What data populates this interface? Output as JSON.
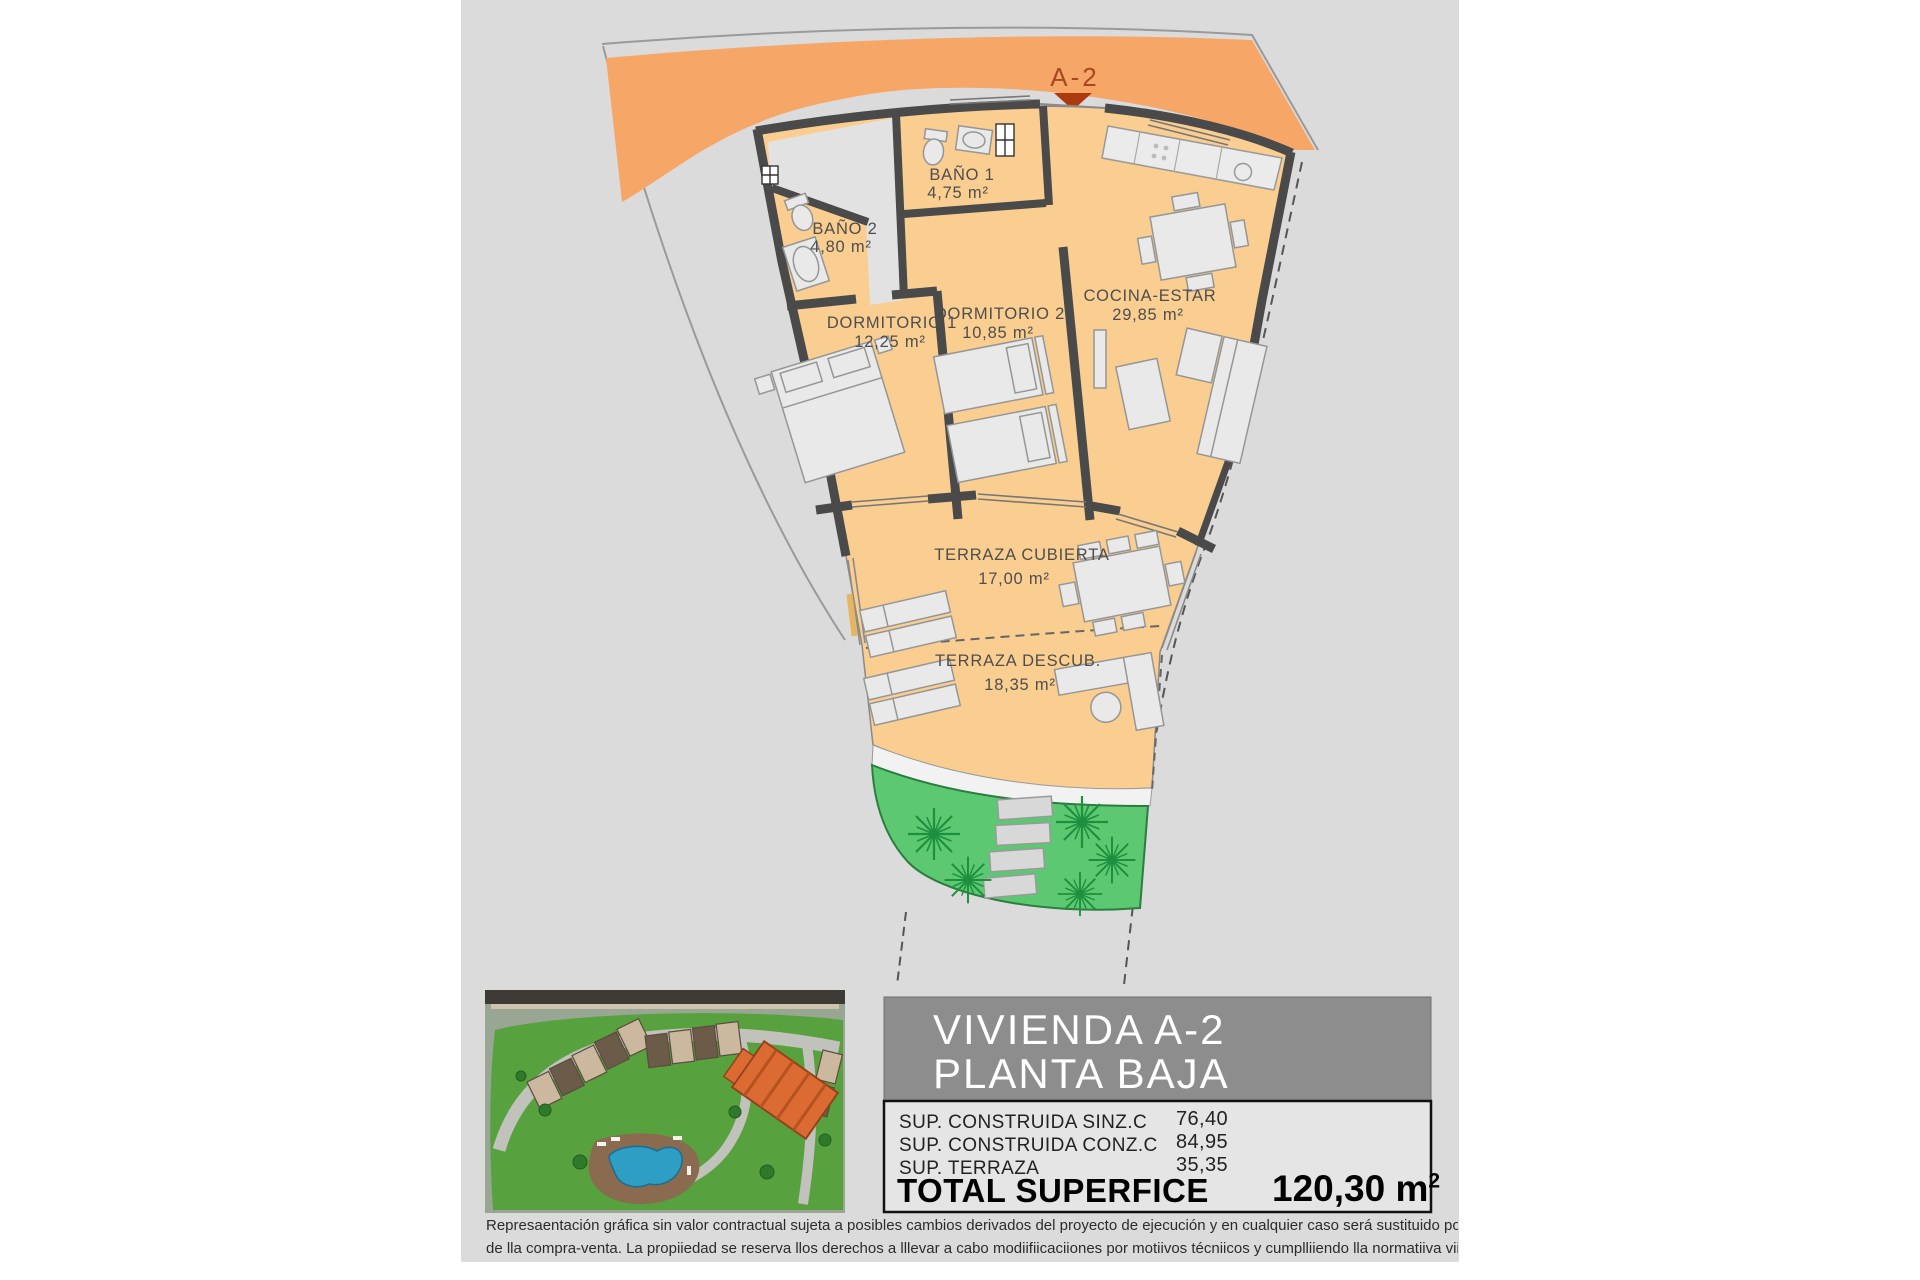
{
  "plan": {
    "marker": {
      "label": "A-2"
    },
    "rooms": [
      {
        "name": "BAÑO 1",
        "area": "4,75 m²"
      },
      {
        "name": "BAÑO 2",
        "area": "4,80 m²"
      },
      {
        "name": "DORMITORIO 1",
        "area": "12,25 m²"
      },
      {
        "name": "DORMITORIO 2",
        "area": "10,85 m²"
      },
      {
        "name": "COCINA-ESTAR",
        "area": "29,85 m²"
      },
      {
        "name": "TERRAZA CUBIERTA",
        "area": "17,00 m²"
      },
      {
        "name": "TERRAZA DESCUB.",
        "area": "18,35 m²"
      }
    ],
    "colors": {
      "access_band": "#F6A768",
      "floor": "#F9CE90",
      "wall": "#4a4a4a",
      "hall_floor": "#E2E2E2",
      "garden": "#5CC972",
      "palm": "#1E8F3E",
      "marker_text": "#A8481E"
    }
  },
  "info_panel": {
    "title_line1": "VIVIENDA A-2",
    "title_line2": "PLANTA BAJA",
    "rows": [
      {
        "label": "SUP. CONSTRUIDA SINZ.C",
        "value": "76,40"
      },
      {
        "label": "SUP. CONSTRUIDA CONZ.C",
        "value": "84,95"
      },
      {
        "label": "SUP. TERRAZA",
        "value": "35,35"
      }
    ],
    "total_label": "TOTAL SUPERFICE",
    "total_value": "120,30 m",
    "total_sup": "2",
    "title_bg": "#8D8D8D",
    "table_bg": "#E5E5E5"
  },
  "disclaimer": {
    "line1": "Represaentación gráfica sin valor contractual sujeta a posibles cambios derivados del proyecto de ejecución y en cualquier caso será sustituido por el definitivo er",
    "line2": "de lla compra-venta. La propiiedad se reserva llos derechos a lllevar a cabo modiifiicaciiones por motiivos técniicos y cumplliiendo lla normatiiva viigente."
  }
}
